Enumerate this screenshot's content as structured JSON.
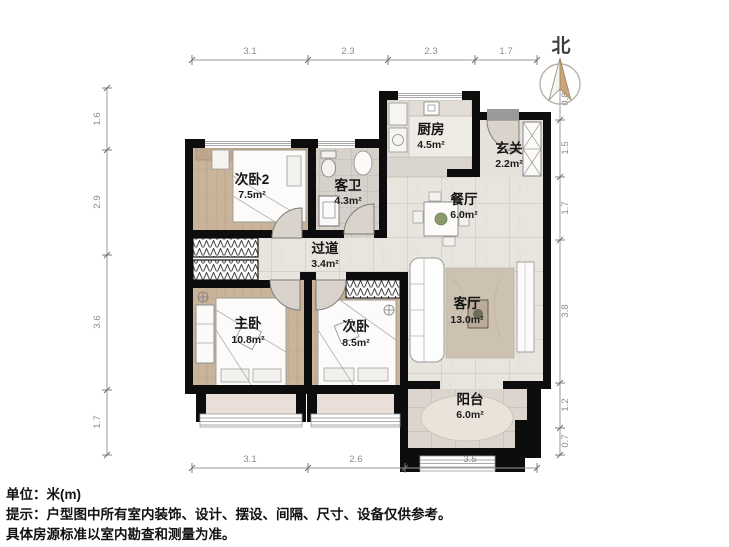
{
  "north": {
    "label": "北"
  },
  "rooms": {
    "bedroom2": {
      "name": "次卧2",
      "area": "7.5m²"
    },
    "bathroom": {
      "name": "客卫",
      "area": "4.3m²"
    },
    "kitchen": {
      "name": "厨房",
      "area": "4.5m²"
    },
    "foyer": {
      "name": "玄关",
      "area": "2.2m²"
    },
    "dining": {
      "name": "餐厅",
      "area": "6.0m²"
    },
    "hallway": {
      "name": "过道",
      "area": "3.4m²"
    },
    "master_bedroom": {
      "name": "主卧",
      "area": "10.8m²"
    },
    "bedroom": {
      "name": "次卧",
      "area": "8.5m²"
    },
    "living_room": {
      "name": "客厅",
      "area": "13.0m²"
    },
    "balcony": {
      "name": "阳台",
      "area": "6.0m²"
    }
  },
  "dimensions": {
    "top": [
      "3.1",
      "2.3",
      "2.3",
      "1.7"
    ],
    "bottom": [
      "3.1",
      "2.6",
      "3.5"
    ],
    "left": [
      "1.6",
      "2.9",
      "3.6",
      "1.7"
    ],
    "right": [
      "0.8",
      "1.5",
      "1.7",
      "3.8",
      "1.2",
      "0.7"
    ]
  },
  "footer": {
    "unit": "单位：米(m)",
    "note1": "提示：户型图中所有室内装饰、设计、摆设、间隔、尺寸、设备仅供参考。",
    "note2": "具体房源标准以室内勘查和测量为准。"
  },
  "colors": {
    "wall": "#0d0d0d",
    "wood_floor": "#c9b39b",
    "marble_floor": "#e8e4de",
    "bath_tile": "#d6d1cb",
    "balcony_tile": "#dbd5cd",
    "rug": "#cdc2b2",
    "north_needle": "#c9a37a"
  }
}
